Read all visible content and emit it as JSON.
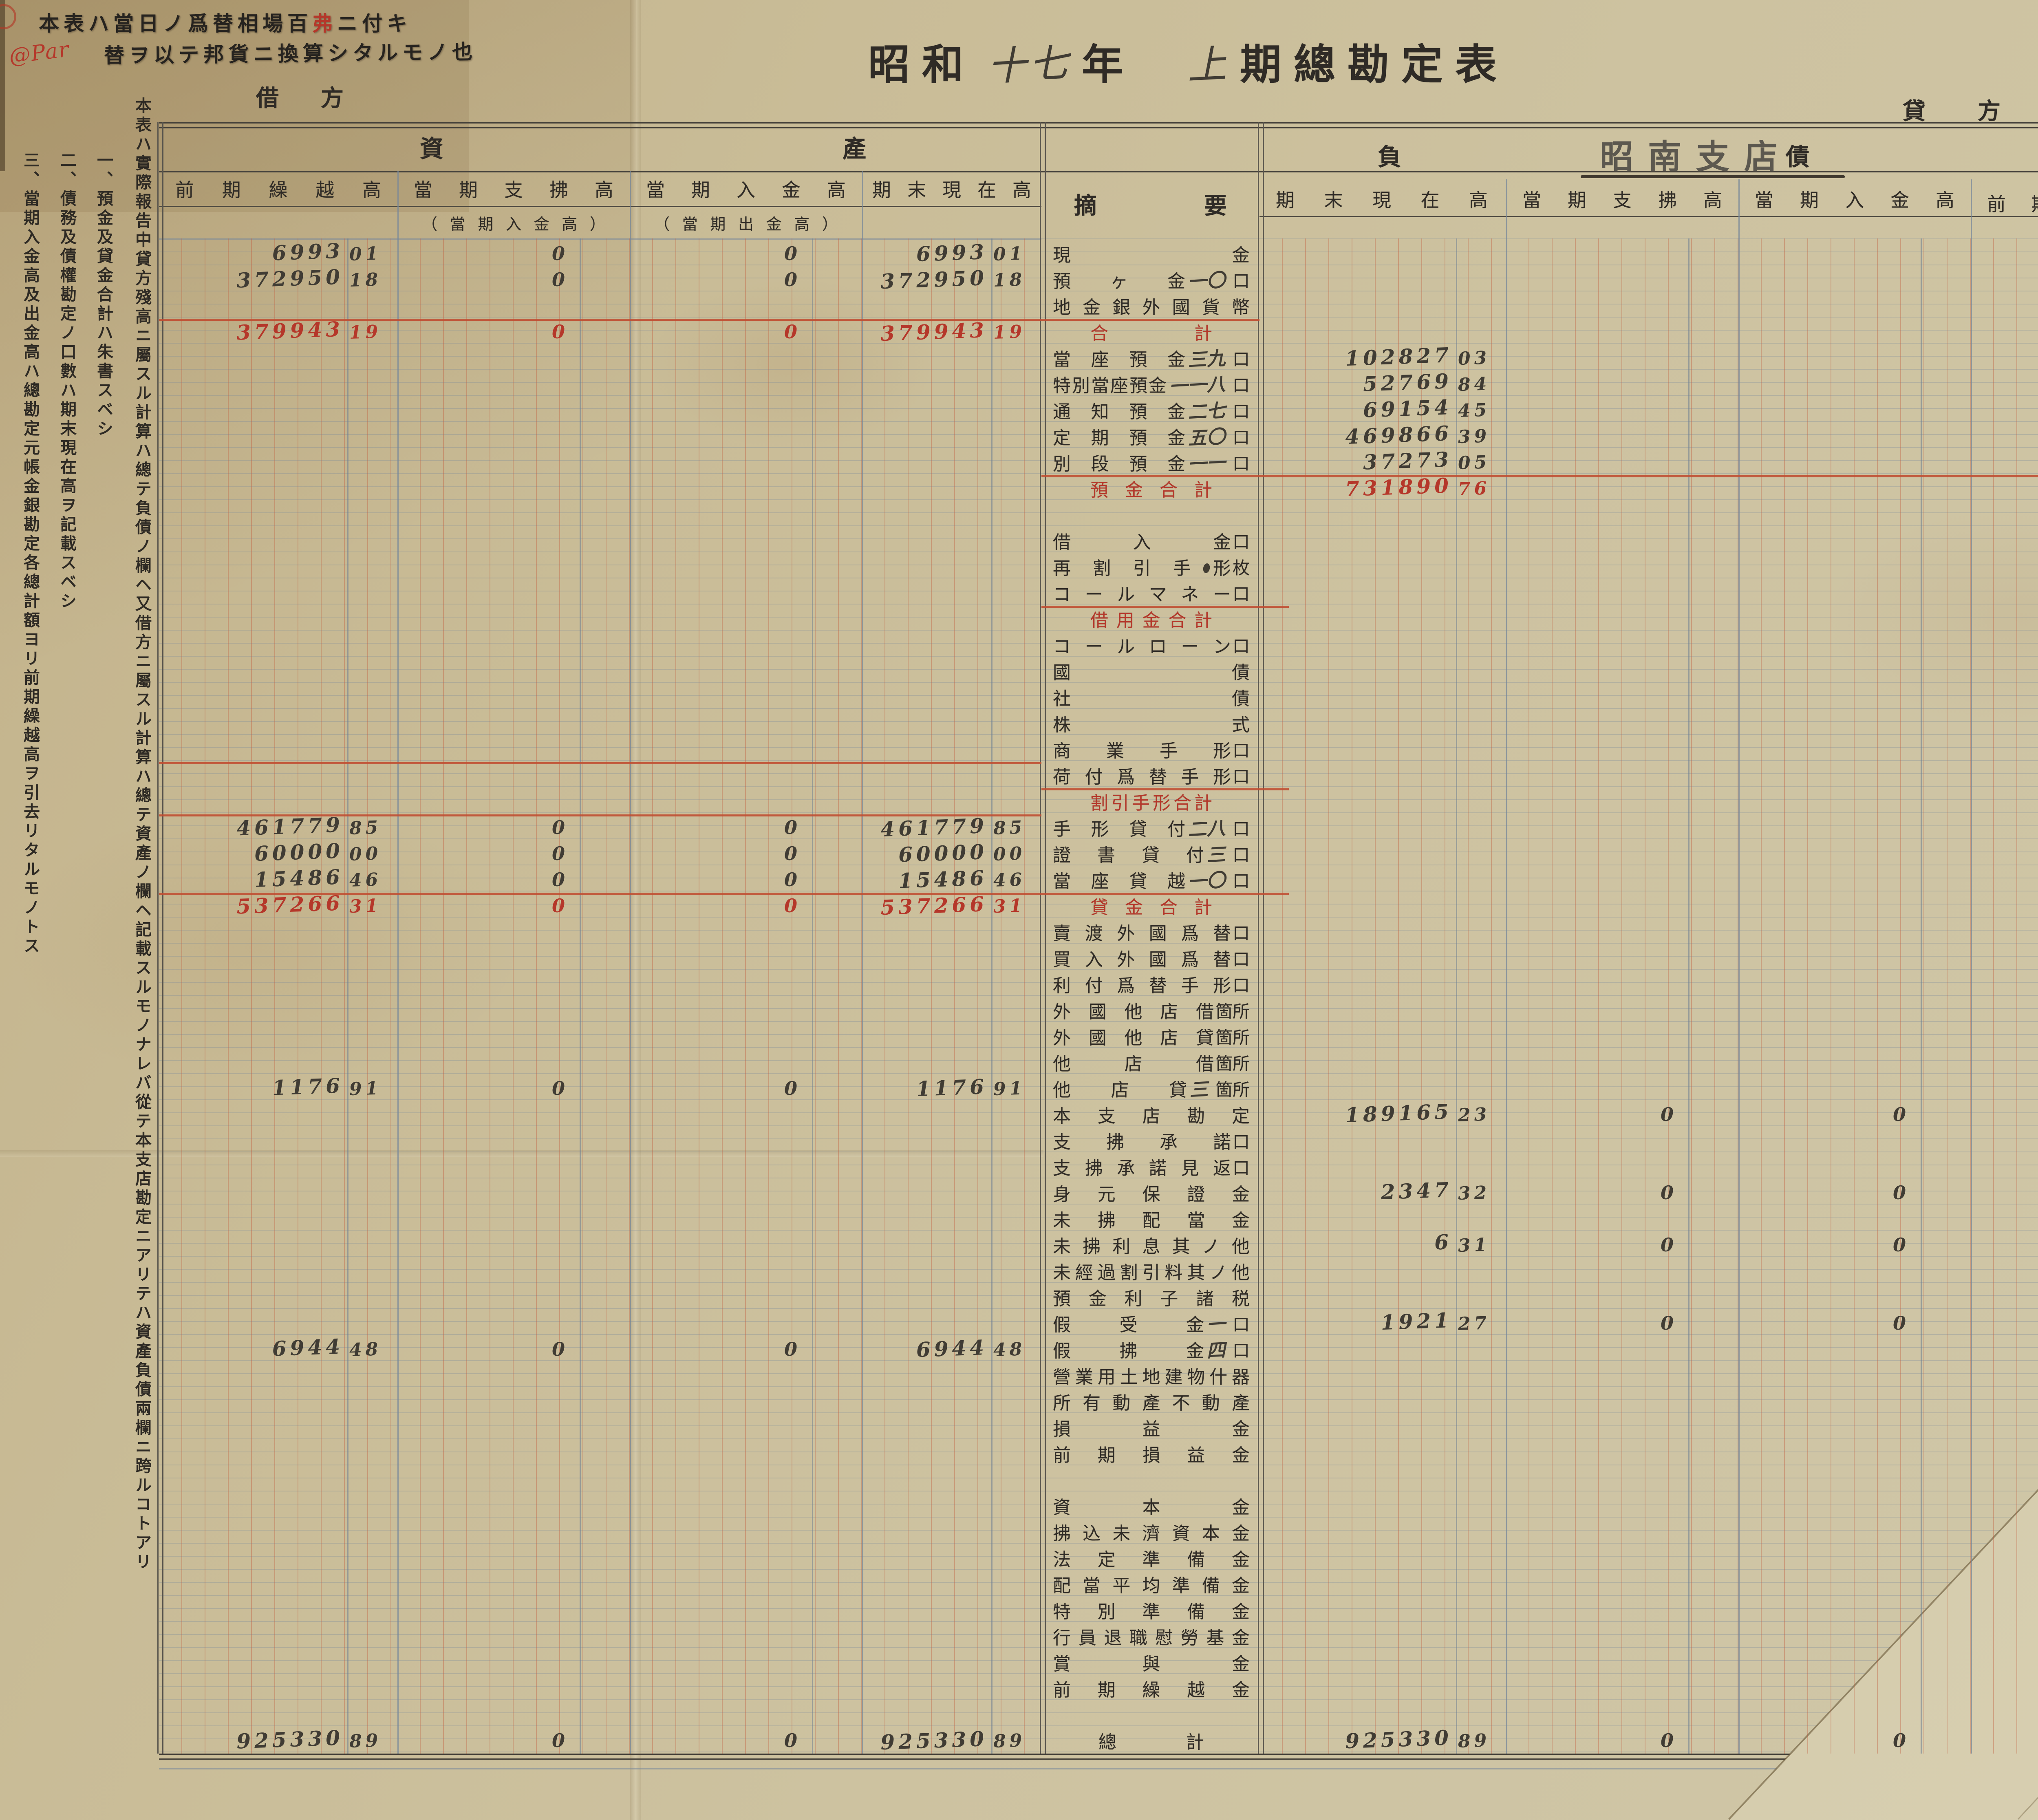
{
  "document": {
    "stamp": {
      "line1_pre": "本表ハ當日ノ爲替相場百",
      "line1_red": "弗",
      "line1_post": "ニ付キ",
      "line2": "替ヲ以テ邦貨ニ換算シタルモノ也",
      "annotation": "@Par"
    },
    "title": {
      "printed_era": "昭和",
      "hand_year": "十七",
      "printed_year_suffix": "年",
      "hand_term": "上",
      "printed_rest": "期總勘定表"
    },
    "branch": "昭南支店",
    "debit_label": "借方",
    "credit_label": "貸方",
    "asset_section_label": "資產",
    "liability_section_label": "負債",
    "summary_label": "摘要",
    "asset_headers": [
      "前期繰越高",
      "當期支拂高",
      "當期入金高",
      "期末現在高"
    ],
    "asset_subheaders": [
      "（當期入金高）",
      "（當期出金高）"
    ],
    "liability_headers": [
      "期末現在高",
      "當期支拂高",
      "當期入金高",
      "前期繰越高"
    ],
    "margin_note_main": "本表ハ實際報告中貸方殘高ニ屬スル計算ハ總テ負債ノ欄ヘ又借方ニ屬スル計算ハ總テ資產ノ欄ヘ記載スルモノナレバ從テ本支店勘定ニアリテハ資產負債兩欄ニ跨ルコトアリ",
    "margin_notes": [
      "一、預金及貸金合計ハ朱書スベシ",
      "二、債務及債權勘定ノ口數ハ期末現在高ヲ記載スベシ",
      "三、當期入金高及出金高ハ總勘定元帳金銀勘定各總計額ヨリ前期繰越高ヲ引去リタルモノトス"
    ],
    "colors": {
      "paper": "#cbbf9b",
      "ink_printed": "#2f2b26",
      "ink_hand": "#403c34",
      "ink_red": "#b5372a",
      "rule_red": "#c04f33",
      "rule_blue": "#76879a"
    }
  },
  "rows": [
    {
      "label": "現金",
      "a": [
        "6993|01",
        "0",
        "0",
        "6993|01"
      ]
    },
    {
      "label": "預ヶ金",
      "count": "一〇",
      "unit": "口",
      "a": [
        "372950|18",
        "0",
        "0",
        "372950|18"
      ]
    },
    {
      "label": "地金銀外國貨幣"
    },
    {
      "label": "合計",
      "red": true,
      "total": true,
      "a": [
        "379943|19",
        "0",
        "0",
        "379943|19"
      ]
    },
    {
      "label": "當座預金",
      "count": "三九",
      "unit": "口",
      "l": [
        "102827|03",
        "",
        "",
        "102827|03"
      ]
    },
    {
      "label": "特別當座預金",
      "count": "一一八",
      "unit": "口",
      "l": [
        "52769|84",
        "",
        "",
        "52769|84"
      ]
    },
    {
      "label": "通知預金",
      "count": "二七",
      "unit": "口",
      "l": [
        "69154|45",
        "",
        "",
        "69154|45"
      ]
    },
    {
      "label": "定期預金",
      "count": "五〇",
      "unit": "口",
      "l": [
        "469866|39",
        "",
        "",
        "469866|39"
      ]
    },
    {
      "label": "別段預金",
      "count": "一一",
      "unit": "口",
      "l": [
        "37273|05",
        "",
        "",
        "37273|05"
      ]
    },
    {
      "label": "預金合計",
      "red": true,
      "total": true,
      "l": [
        "731890|76",
        "",
        "",
        "731890|76"
      ]
    },
    {},
    {
      "label": "借入金",
      "unit": "口"
    },
    {
      "label": "再割引手形",
      "unit": "枚"
    },
    {
      "label": "コールマネー",
      "unit": "口"
    },
    {
      "label": "借用金合計",
      "red": true,
      "total": true
    },
    {
      "label": "コールローン",
      "unit": "口"
    },
    {
      "label": "國債"
    },
    {
      "label": "社債"
    },
    {
      "label": "株式"
    },
    {
      "label": "商業手形",
      "unit": "口"
    },
    {
      "label": "荷付爲替手形",
      "unit": "口"
    },
    {
      "label": "割引手形合計",
      "red": true,
      "total": true
    },
    {
      "label": "手形貸付",
      "count": "二八",
      "unit": "口",
      "a": [
        "461779|85",
        "0",
        "0",
        "461779|85"
      ]
    },
    {
      "label": "證書貸付",
      "count": "三",
      "unit": "口",
      "a": [
        "60000|00",
        "0",
        "0",
        "60000|00"
      ]
    },
    {
      "label": "當座貸越",
      "count": "一〇",
      "unit": "口",
      "a": [
        "15486|46",
        "0",
        "0",
        "15486|46"
      ]
    },
    {
      "label": "貸金合計",
      "red": true,
      "total": true,
      "a": [
        "537266|31",
        "0",
        "0",
        "537266|31"
      ]
    },
    {
      "label": "賣渡外國爲替",
      "unit": "口"
    },
    {
      "label": "買入外國爲替",
      "unit": "口"
    },
    {
      "label": "利付爲替手形",
      "unit": "口"
    },
    {
      "label": "外國他店借",
      "unit": "箇所"
    },
    {
      "label": "外國他店貸",
      "unit": "箇所"
    },
    {
      "label": "他店借",
      "unit": "箇所"
    },
    {
      "label": "他店貸",
      "count": "三",
      "unit": "箇所",
      "a": [
        "1176|91",
        "0",
        "0",
        "1176|91"
      ]
    },
    {
      "label": "本支店勘定",
      "l": [
        "189165|23",
        "0",
        "0",
        "189165|23"
      ]
    },
    {
      "label": "支拂承諾",
      "unit": "口"
    },
    {
      "label": "支拂承諾見返",
      "unit": "口"
    },
    {
      "label": "身元保證金",
      "l": [
        "2347|32",
        "0",
        "0",
        "2347|32"
      ]
    },
    {
      "label": "未拂配當金"
    },
    {
      "label": "未拂利息其ノ他",
      "l": [
        "6|31",
        "0",
        "0",
        "6|31"
      ]
    },
    {
      "label": "未經過割引料其ノ他"
    },
    {
      "label": "預金利子諸税"
    },
    {
      "label": "假受金",
      "count": "一",
      "unit": "口",
      "l": [
        "1921|27",
        "0",
        "0",
        "1921|27"
      ]
    },
    {
      "label": "假拂金",
      "count": "四",
      "unit": "口",
      "a": [
        "6944|48",
        "0",
        "0",
        "6944|48"
      ]
    },
    {
      "label": "營業用土地建物什器"
    },
    {
      "label": "所有動產不動產"
    },
    {
      "label": "損益金"
    },
    {
      "label": "前期損益金"
    },
    {},
    {
      "label": "資本金"
    },
    {
      "label": "拂込未濟資本金"
    },
    {
      "label": "法定準備金"
    },
    {
      "label": "配當平均準備金"
    },
    {
      "label": "特別準備金"
    },
    {
      "label": "行員退職慰勞基金"
    },
    {
      "label": "賞與金"
    },
    {
      "label": "前期繰越金"
    },
    {},
    {
      "label": "總計",
      "grand": true,
      "a": [
        "925330|89",
        "0",
        "0",
        "925330|89"
      ],
      "l": [
        "925330|89",
        "0",
        "0",
        "925330|89"
      ]
    }
  ]
}
